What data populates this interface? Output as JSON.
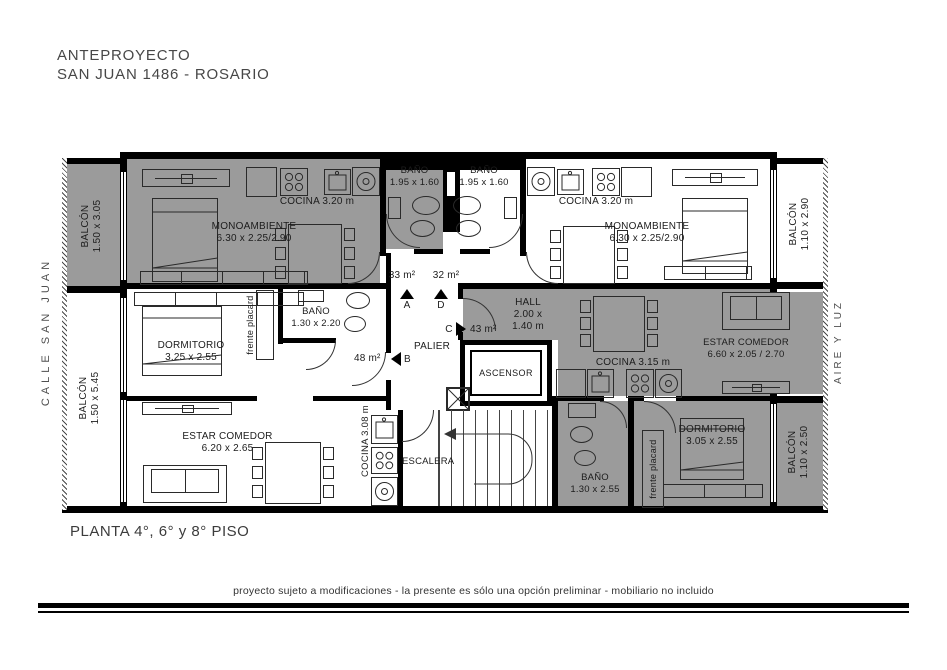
{
  "title": {
    "line1": "ANTEPROYECTO",
    "line2": "SAN JUAN 1486 - ROSARIO"
  },
  "street_label": "CALLE SAN JUAN",
  "air_label": "AIRE Y LUZ",
  "floor_label": "PLANTA 4°, 6° y 8° PISO",
  "disclaimer": "proyecto sujeto a modificaciones - la presente es sólo una opción preliminar - mobiliario no incluido",
  "colors": {
    "shaded_unit": "#9b9b9b",
    "wall": "#000000",
    "paper": "#ffffff"
  },
  "balconies": {
    "top_left": {
      "name": "BALCÓN",
      "dims": "1.50 x 3.05"
    },
    "bottom_left": {
      "name": "BALCÓN",
      "dims": "1.50 x 5.45"
    },
    "top_right": {
      "name": "BALCÓN",
      "dims": "1.10 x 2.90"
    },
    "bottom_right": {
      "name": "BALCÓN",
      "dims": "1.10 x 2.50"
    }
  },
  "unit_a": {
    "entry": "A",
    "area": "33 m²",
    "room": "MONOAMBIENTE",
    "room_dims": "6.30 x 2.25/2.90",
    "kitchen": "COCINA 3.20 m",
    "bath": "BAÑO",
    "bath_dims": "1.95 x 1.60"
  },
  "unit_d": {
    "entry": "D",
    "area": "32 m²",
    "room": "MONOAMBIENTE",
    "room_dims": "6.30 x 2.25/2.90",
    "kitchen": "COCINA 3.20 m",
    "bath": "BAÑO",
    "bath_dims": "1.95 x 1.60"
  },
  "unit_b": {
    "entry": "B",
    "area": "48 m²",
    "bedroom": "DORMITORIO",
    "bedroom_dims": "3.25 x 2.55",
    "living": "ESTAR COMEDOR",
    "living_dims": "6.20 x 2.65",
    "kitchen": "COCINA 3.08 m",
    "bath": "BAÑO",
    "bath_dims": "1.30 x 2.20",
    "closet": "frente placard"
  },
  "unit_c": {
    "entry": "C",
    "area": "43 m²",
    "hall": "HALL",
    "hall_dims_1": "2.00 x",
    "hall_dims_2": "1.40 m",
    "living": "ESTAR COMEDOR",
    "living_dims": "6.60 x 2.05 / 2.70",
    "kitchen": "COCINA 3.15 m",
    "bedroom": "DORMITORIO",
    "bedroom_dims": "3.05 x 2.55",
    "bath": "BAÑO",
    "bath_dims": "1.30 x 2.55",
    "closet": "frente placard"
  },
  "common": {
    "palier": "PALIER",
    "elevator": "ASCENSOR",
    "stairs": "ESCALERA"
  }
}
